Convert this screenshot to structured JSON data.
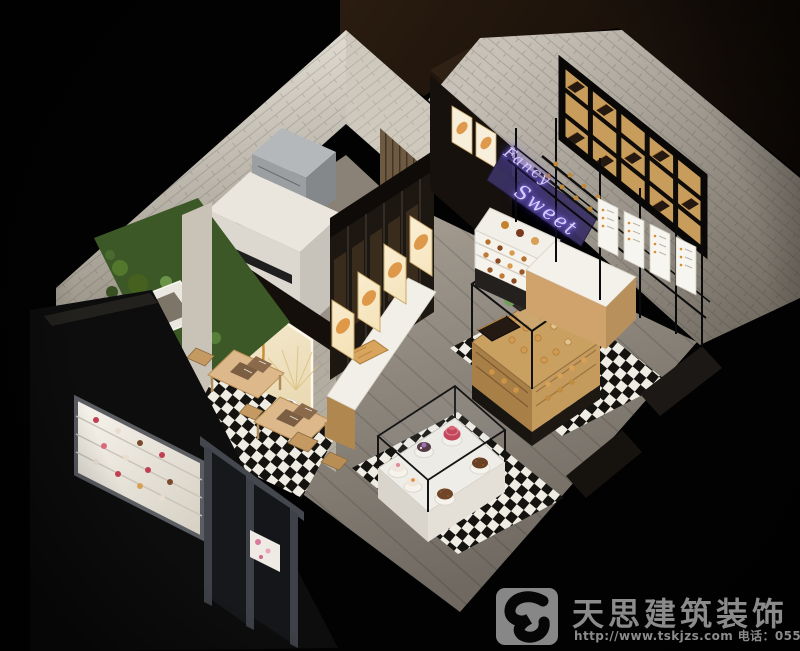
{
  "neon_sign": {
    "line1": "Fancy",
    "line2": "Sweet"
  },
  "watermark": {
    "company": "天思建筑装饰",
    "contact": "http://www.tskjzs.com 电话：0551-65568226"
  },
  "palette": {
    "background": "#020202",
    "neon_text": "#d9cdff",
    "neon_panel": "#3b3263",
    "warm_wood": "#c89c5a",
    "floor_gray": "#938c81",
    "checker_light": "#efece4",
    "checker_dark": "#15130f",
    "watermark_gray": "#8b8b8b"
  }
}
